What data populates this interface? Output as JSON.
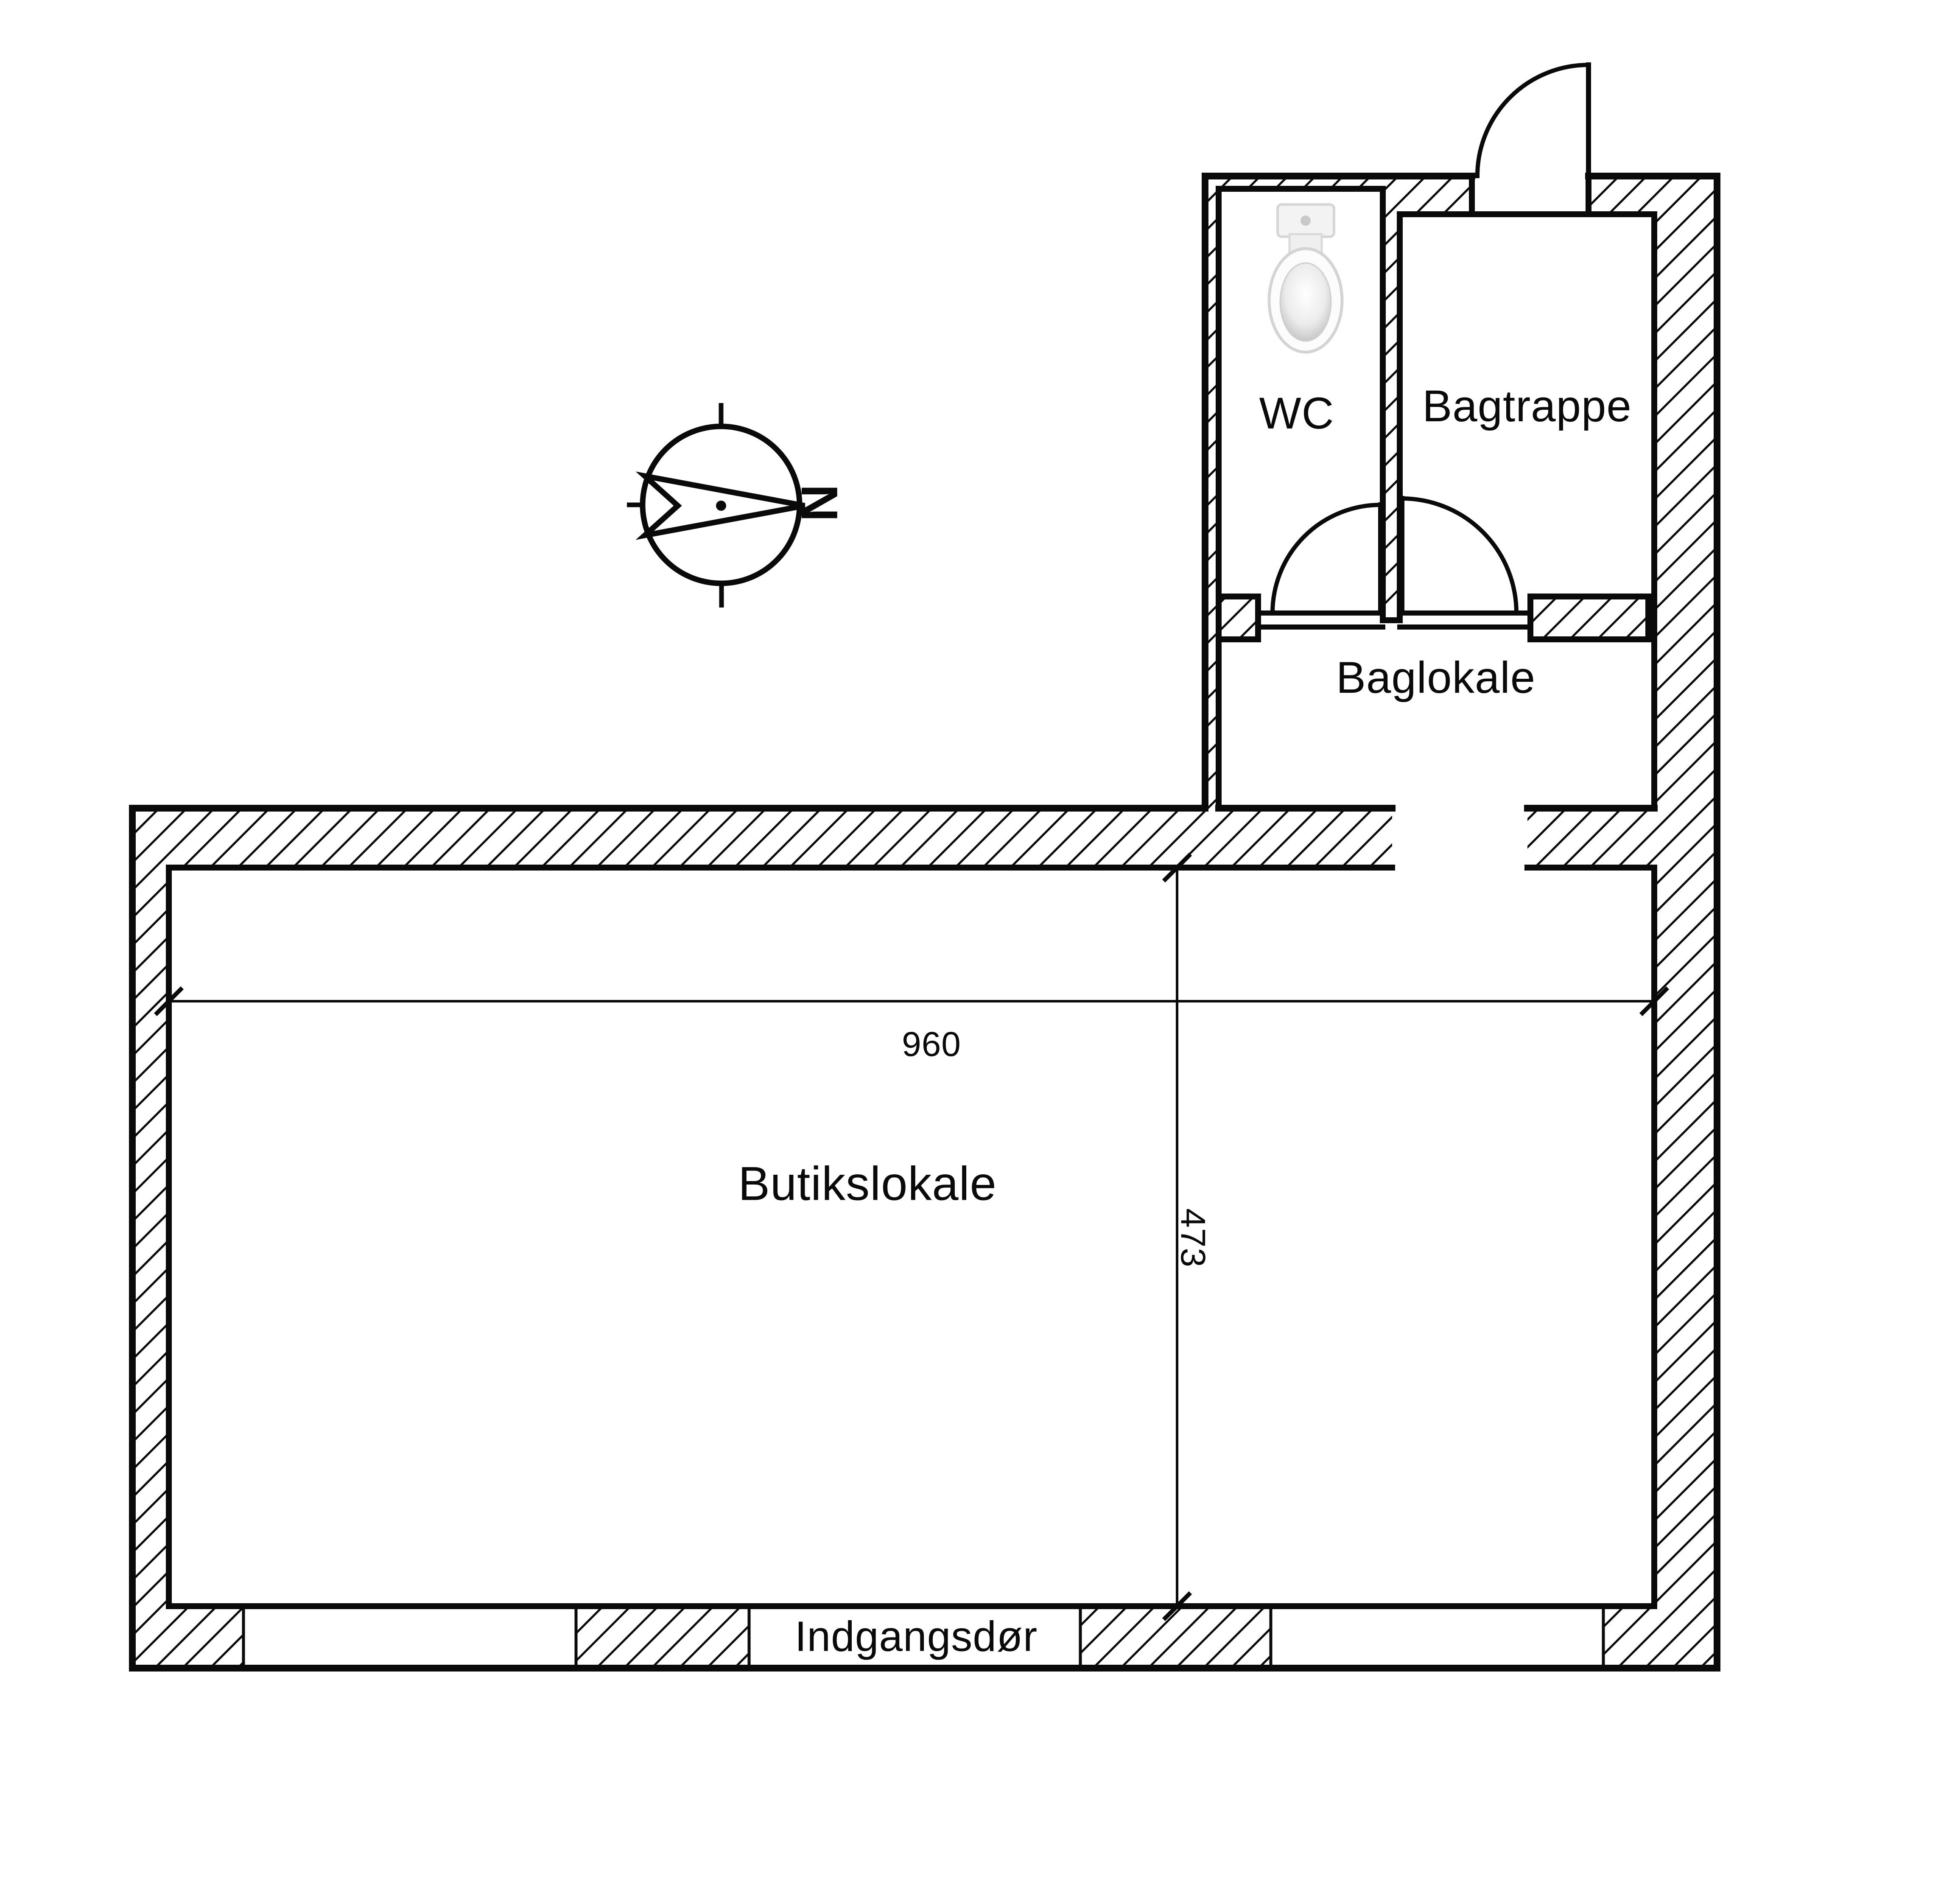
{
  "title": "Butikslokale floor plan",
  "colors": {
    "line": "#000000",
    "background": "#ffffff",
    "toilet_tank": "#f3f3f3",
    "toilet_outline": "#d6d6d6"
  },
  "floor_plan": {
    "rooms": [
      {
        "id": "wc",
        "name": "WC"
      },
      {
        "id": "bagtrappe",
        "name": "Bagtrappe"
      },
      {
        "id": "baglokale",
        "name": "Baglokale"
      },
      {
        "id": "butikslokale",
        "name": "Butikslokale"
      }
    ],
    "entrance_label": "Indgangsdør",
    "dimensions": {
      "width": "960",
      "depth": "473"
    },
    "compass": {
      "north_label": "N"
    },
    "icons": [
      {
        "name": "toilet-icon",
        "room": "wc"
      },
      {
        "name": "compass-north-icon"
      },
      {
        "name": "door-swing-icon",
        "count": 3
      }
    ]
  }
}
